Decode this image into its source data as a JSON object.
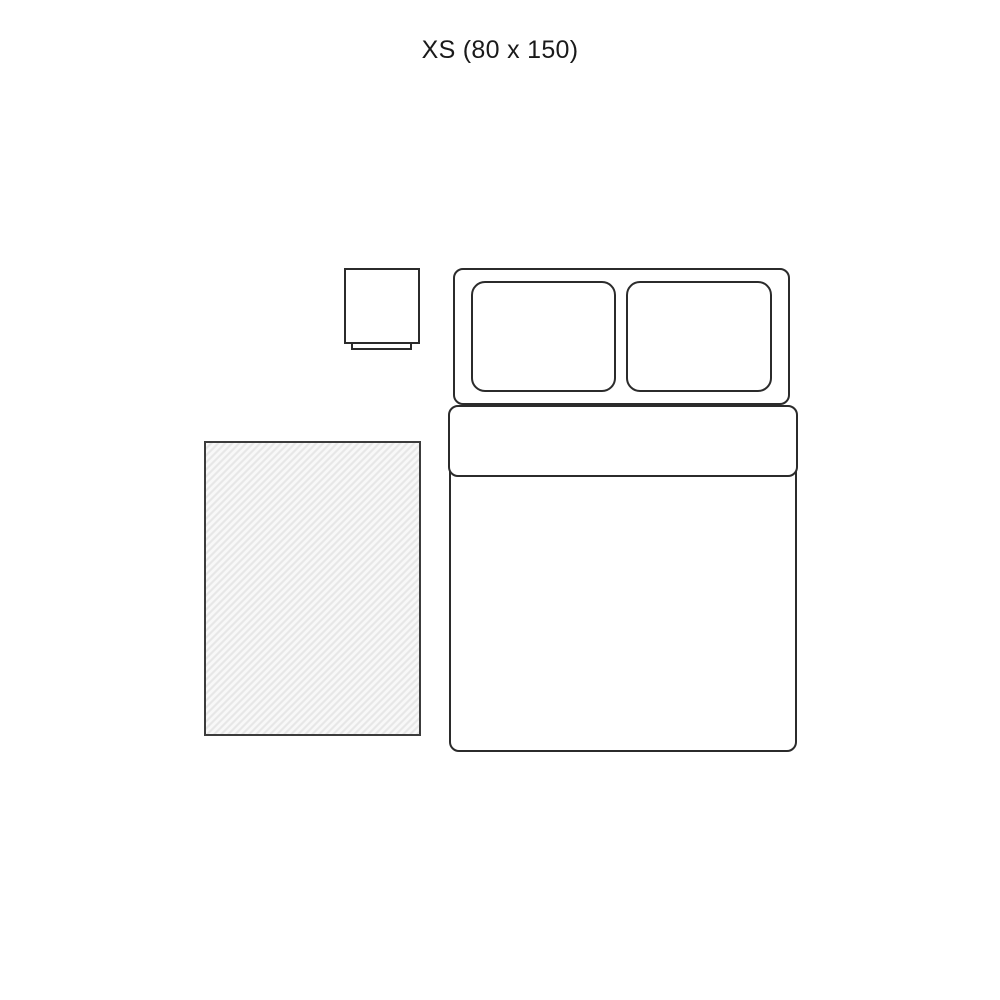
{
  "title": "XS (80 x 150)",
  "size": {
    "code": "XS",
    "dimensions": "80 x 150"
  },
  "colors": {
    "background": "#ffffff",
    "title_text": "#1a1a1a",
    "furniture_fill": "#ffffff",
    "furniture_outline": "#2b2b2b",
    "rug_border": "#3c3c3c",
    "rug_base": "#e7e7e7",
    "rug_stripe": "#f8f8f8"
  }
}
